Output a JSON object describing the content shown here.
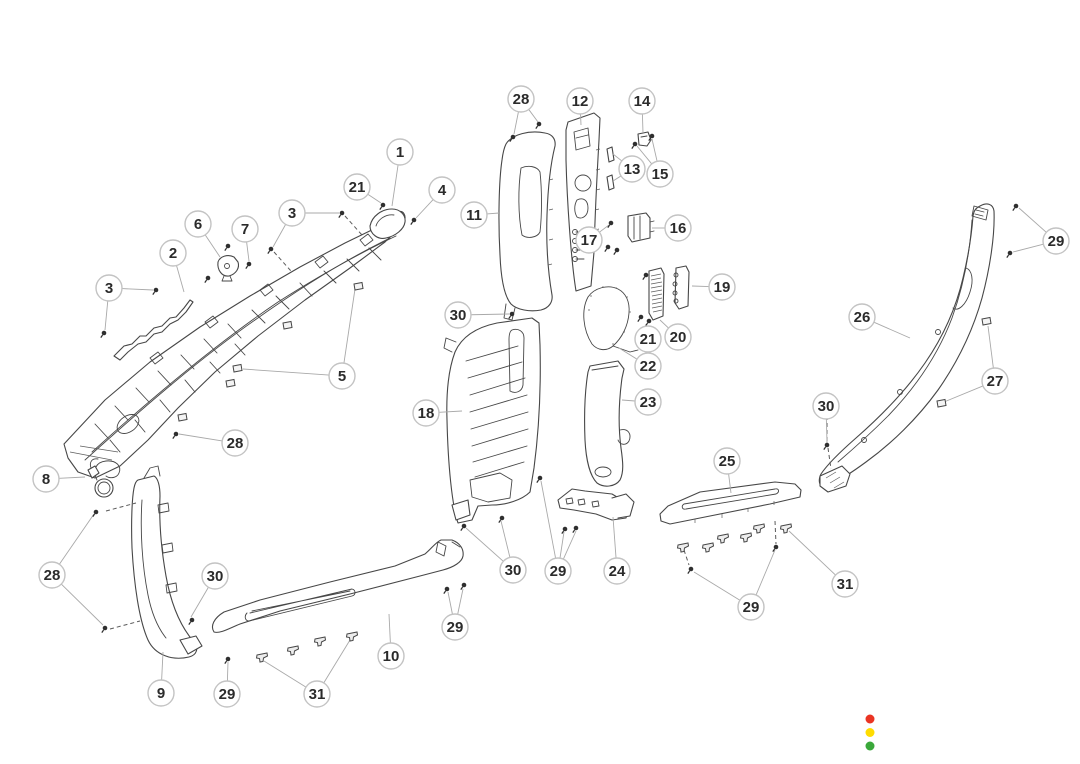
{
  "diagram": {
    "canvas": {
      "width": 1080,
      "height": 764,
      "background": "#ffffff"
    },
    "style": {
      "line_color": "#474747",
      "leader_color": "#a9a9a9",
      "dash_color": "#5a5a5a",
      "fastener_color": "#2f2f2f",
      "callout_fill": "#ffffff",
      "callout_border": "#c3c3c3",
      "callout_text_color": "#2b2b2b",
      "callout_radius": 13
    },
    "callouts": [
      {
        "label": "1",
        "x": 400,
        "y": 152,
        "leaders": [
          [
            392,
            206
          ]
        ]
      },
      {
        "label": "21",
        "x": 357,
        "y": 187,
        "leaders": [
          [
            381,
            203
          ]
        ]
      },
      {
        "label": "4",
        "x": 442,
        "y": 190,
        "leaders": [
          [
            416,
            218
          ]
        ]
      },
      {
        "label": "3",
        "x": 292,
        "y": 213,
        "leaders": [
          [
            339,
            213
          ],
          [
            273,
            247
          ]
        ]
      },
      {
        "label": "6",
        "x": 198,
        "y": 224,
        "leaders": [
          [
            220,
            257
          ]
        ]
      },
      {
        "label": "7",
        "x": 245,
        "y": 229,
        "leaders": [
          [
            249,
            261
          ]
        ]
      },
      {
        "label": "2",
        "x": 173,
        "y": 253,
        "leaders": [
          [
            184,
            292
          ]
        ]
      },
      {
        "label": "3",
        "x": 109,
        "y": 288,
        "leaders": [
          [
            153,
            290
          ],
          [
            105,
            330
          ]
        ]
      },
      {
        "label": "5",
        "x": 342,
        "y": 376,
        "leaders": [
          [
            355,
            289
          ],
          [
            243,
            369
          ]
        ]
      },
      {
        "label": "28",
        "x": 521,
        "y": 99,
        "leaders": [
          [
            514,
            134
          ],
          [
            538,
            122
          ]
        ]
      },
      {
        "label": "12",
        "x": 580,
        "y": 101,
        "leaders": [
          [
            581,
            125
          ]
        ]
      },
      {
        "label": "14",
        "x": 642,
        "y": 101,
        "leaders": [
          [
            643,
            133
          ]
        ]
      },
      {
        "label": "13",
        "x": 632,
        "y": 169,
        "leaders": [
          [
            613,
            154
          ],
          [
            613,
            181
          ]
        ]
      },
      {
        "label": "15",
        "x": 660,
        "y": 174,
        "leaders": [
          [
            637,
            146
          ],
          [
            652,
            139
          ]
        ]
      },
      {
        "label": "11",
        "x": 474,
        "y": 215,
        "leaders": [
          [
            499,
            213
          ]
        ]
      },
      {
        "label": "16",
        "x": 678,
        "y": 228,
        "leaders": [
          [
            652,
            228
          ]
        ]
      },
      {
        "label": "17",
        "x": 589,
        "y": 240,
        "leaders": [
          [
            609,
            225
          ]
        ]
      },
      {
        "label": "19",
        "x": 722,
        "y": 287,
        "leaders": [
          [
            692,
            286
          ]
        ]
      },
      {
        "label": "29",
        "x": 1056,
        "y": 241,
        "leaders": [
          [
            1019,
            208
          ],
          [
            1013,
            252
          ]
        ]
      },
      {
        "label": "30",
        "x": 458,
        "y": 315,
        "leaders": [
          [
            509,
            314
          ]
        ]
      },
      {
        "label": "26",
        "x": 862,
        "y": 317,
        "leaders": [
          [
            910,
            338
          ]
        ]
      },
      {
        "label": "21",
        "x": 648,
        "y": 339,
        "leaders": [
          [
            646,
            324
          ]
        ]
      },
      {
        "label": "20",
        "x": 678,
        "y": 337,
        "leaders": [
          [
            660,
            320
          ]
        ]
      },
      {
        "label": "22",
        "x": 648,
        "y": 366,
        "leaders": [
          [
            619,
            348
          ]
        ]
      },
      {
        "label": "27",
        "x": 995,
        "y": 381,
        "leaders": [
          [
            988,
            326
          ],
          [
            944,
            402
          ]
        ]
      },
      {
        "label": "23",
        "x": 648,
        "y": 402,
        "leaders": [
          [
            622,
            400
          ]
        ]
      },
      {
        "label": "18",
        "x": 426,
        "y": 413,
        "leaders": [
          [
            462,
            411
          ]
        ]
      },
      {
        "label": "30",
        "x": 826,
        "y": 406,
        "leaders": [
          [
            827,
            443
          ]
        ]
      },
      {
        "label": "28",
        "x": 235,
        "y": 443,
        "leaders": [
          [
            179,
            434
          ]
        ]
      },
      {
        "label": "8",
        "x": 46,
        "y": 479,
        "leaders": [
          [
            85,
            477
          ]
        ]
      },
      {
        "label": "25",
        "x": 727,
        "y": 461,
        "leaders": [
          [
            731,
            493
          ]
        ]
      },
      {
        "label": "28",
        "x": 52,
        "y": 575,
        "leaders": [
          [
            94,
            514
          ],
          [
            103,
            625
          ]
        ]
      },
      {
        "label": "30",
        "x": 215,
        "y": 576,
        "leaders": [
          [
            191,
            617
          ]
        ]
      },
      {
        "label": "30",
        "x": 513,
        "y": 570,
        "leaders": [
          [
            466,
            528
          ],
          [
            501,
            521
          ]
        ]
      },
      {
        "label": "29",
        "x": 558,
        "y": 571,
        "leaders": [
          [
            541,
            481
          ],
          [
            564,
            532
          ],
          [
            576,
            531
          ]
        ]
      },
      {
        "label": "24",
        "x": 617,
        "y": 571,
        "leaders": [
          [
            613,
            517
          ]
        ]
      },
      {
        "label": "31",
        "x": 845,
        "y": 584,
        "leaders": [
          [
            789,
            531
          ]
        ]
      },
      {
        "label": "29",
        "x": 455,
        "y": 627,
        "leaders": [
          [
            448,
            592
          ],
          [
            463,
            589
          ]
        ]
      },
      {
        "label": "29",
        "x": 751,
        "y": 607,
        "leaders": [
          [
            694,
            572
          ],
          [
            775,
            550
          ]
        ]
      },
      {
        "label": "10",
        "x": 391,
        "y": 656,
        "leaders": [
          [
            389,
            614
          ]
        ]
      },
      {
        "label": "9",
        "x": 161,
        "y": 693,
        "leaders": [
          [
            163,
            652
          ]
        ]
      },
      {
        "label": "29",
        "x": 227,
        "y": 694,
        "leaders": [
          [
            228,
            662
          ]
        ]
      },
      {
        "label": "31",
        "x": 317,
        "y": 694,
        "leaders": [
          [
            264,
            661
          ],
          [
            350,
            640
          ]
        ]
      }
    ],
    "fasteners": [
      {
        "type": "screw",
        "x": 342,
        "y": 213
      },
      {
        "type": "screw",
        "x": 271,
        "y": 249
      },
      {
        "type": "screw",
        "x": 383,
        "y": 205
      },
      {
        "type": "screw",
        "x": 414,
        "y": 220
      },
      {
        "type": "screw",
        "x": 228,
        "y": 246
      },
      {
        "type": "screw",
        "x": 249,
        "y": 264
      },
      {
        "type": "screw",
        "x": 208,
        "y": 278
      },
      {
        "type": "screw",
        "x": 156,
        "y": 290
      },
      {
        "type": "screw",
        "x": 104,
        "y": 333
      },
      {
        "type": "screw",
        "x": 176,
        "y": 434
      },
      {
        "type": "screw",
        "x": 513,
        "y": 137
      },
      {
        "type": "screw",
        "x": 539,
        "y": 124
      },
      {
        "type": "screw",
        "x": 635,
        "y": 144
      },
      {
        "type": "screw",
        "x": 652,
        "y": 136
      },
      {
        "type": "screw",
        "x": 611,
        "y": 223
      },
      {
        "type": "screw",
        "x": 608,
        "y": 247
      },
      {
        "type": "screw",
        "x": 617,
        "y": 250
      },
      {
        "type": "screw",
        "x": 646,
        "y": 275
      },
      {
        "type": "screw",
        "x": 641,
        "y": 317
      },
      {
        "type": "screw",
        "x": 649,
        "y": 321
      },
      {
        "type": "screw",
        "x": 512,
        "y": 314
      },
      {
        "type": "screw",
        "x": 96,
        "y": 512
      },
      {
        "type": "screw",
        "x": 105,
        "y": 628
      },
      {
        "type": "screw",
        "x": 192,
        "y": 620
      },
      {
        "type": "screw",
        "x": 228,
        "y": 659
      },
      {
        "type": "screw",
        "x": 464,
        "y": 526
      },
      {
        "type": "screw",
        "x": 502,
        "y": 518
      },
      {
        "type": "screw",
        "x": 540,
        "y": 478
      },
      {
        "type": "screw",
        "x": 565,
        "y": 529
      },
      {
        "type": "screw",
        "x": 576,
        "y": 528
      },
      {
        "type": "screw",
        "x": 447,
        "y": 589
      },
      {
        "type": "screw",
        "x": 464,
        "y": 585
      },
      {
        "type": "screw",
        "x": 691,
        "y": 569
      },
      {
        "type": "screw",
        "x": 776,
        "y": 547
      },
      {
        "type": "screw",
        "x": 1016,
        "y": 206
      },
      {
        "type": "screw",
        "x": 1010,
        "y": 253
      },
      {
        "type": "screw",
        "x": 827,
        "y": 445
      },
      {
        "type": "clip",
        "x": 358,
        "y": 286
      },
      {
        "type": "clip",
        "x": 287,
        "y": 325
      },
      {
        "type": "clip",
        "x": 237,
        "y": 368
      },
      {
        "type": "clip",
        "x": 230,
        "y": 383
      },
      {
        "type": "clip",
        "x": 182,
        "y": 417
      },
      {
        "type": "clip",
        "x": 986,
        "y": 321
      },
      {
        "type": "clip",
        "x": 941,
        "y": 403
      },
      {
        "type": "pin",
        "x": 262,
        "y": 657
      },
      {
        "type": "pin",
        "x": 293,
        "y": 650
      },
      {
        "type": "pin",
        "x": 320,
        "y": 641
      },
      {
        "type": "pin",
        "x": 352,
        "y": 636
      },
      {
        "type": "pin",
        "x": 683,
        "y": 547
      },
      {
        "type": "pin",
        "x": 708,
        "y": 547
      },
      {
        "type": "pin",
        "x": 723,
        "y": 538
      },
      {
        "type": "pin",
        "x": 746,
        "y": 537
      },
      {
        "type": "pin",
        "x": 759,
        "y": 528
      },
      {
        "type": "pin",
        "x": 786,
        "y": 528
      }
    ],
    "dashes": [
      [
        345,
        216,
        362,
        235
      ],
      [
        274,
        252,
        291,
        271
      ],
      [
        106,
        511,
        136,
        503
      ],
      [
        110,
        629,
        140,
        621
      ],
      [
        827,
        409,
        827,
        441
      ],
      [
        828,
        448,
        831,
        469
      ],
      [
        684,
        550,
        689,
        565
      ],
      [
        775,
        521,
        776,
        544
      ]
    ],
    "status_dots": [
      {
        "name": "red",
        "color": "#ea3423",
        "x": 870,
        "y": 719,
        "r": 4.5
      },
      {
        "name": "yellow",
        "color": "#ffdc00",
        "x": 870,
        "y": 732.5,
        "r": 4.5
      },
      {
        "name": "green",
        "color": "#3aa83a",
        "x": 870,
        "y": 746,
        "r": 4.5
      }
    ]
  }
}
